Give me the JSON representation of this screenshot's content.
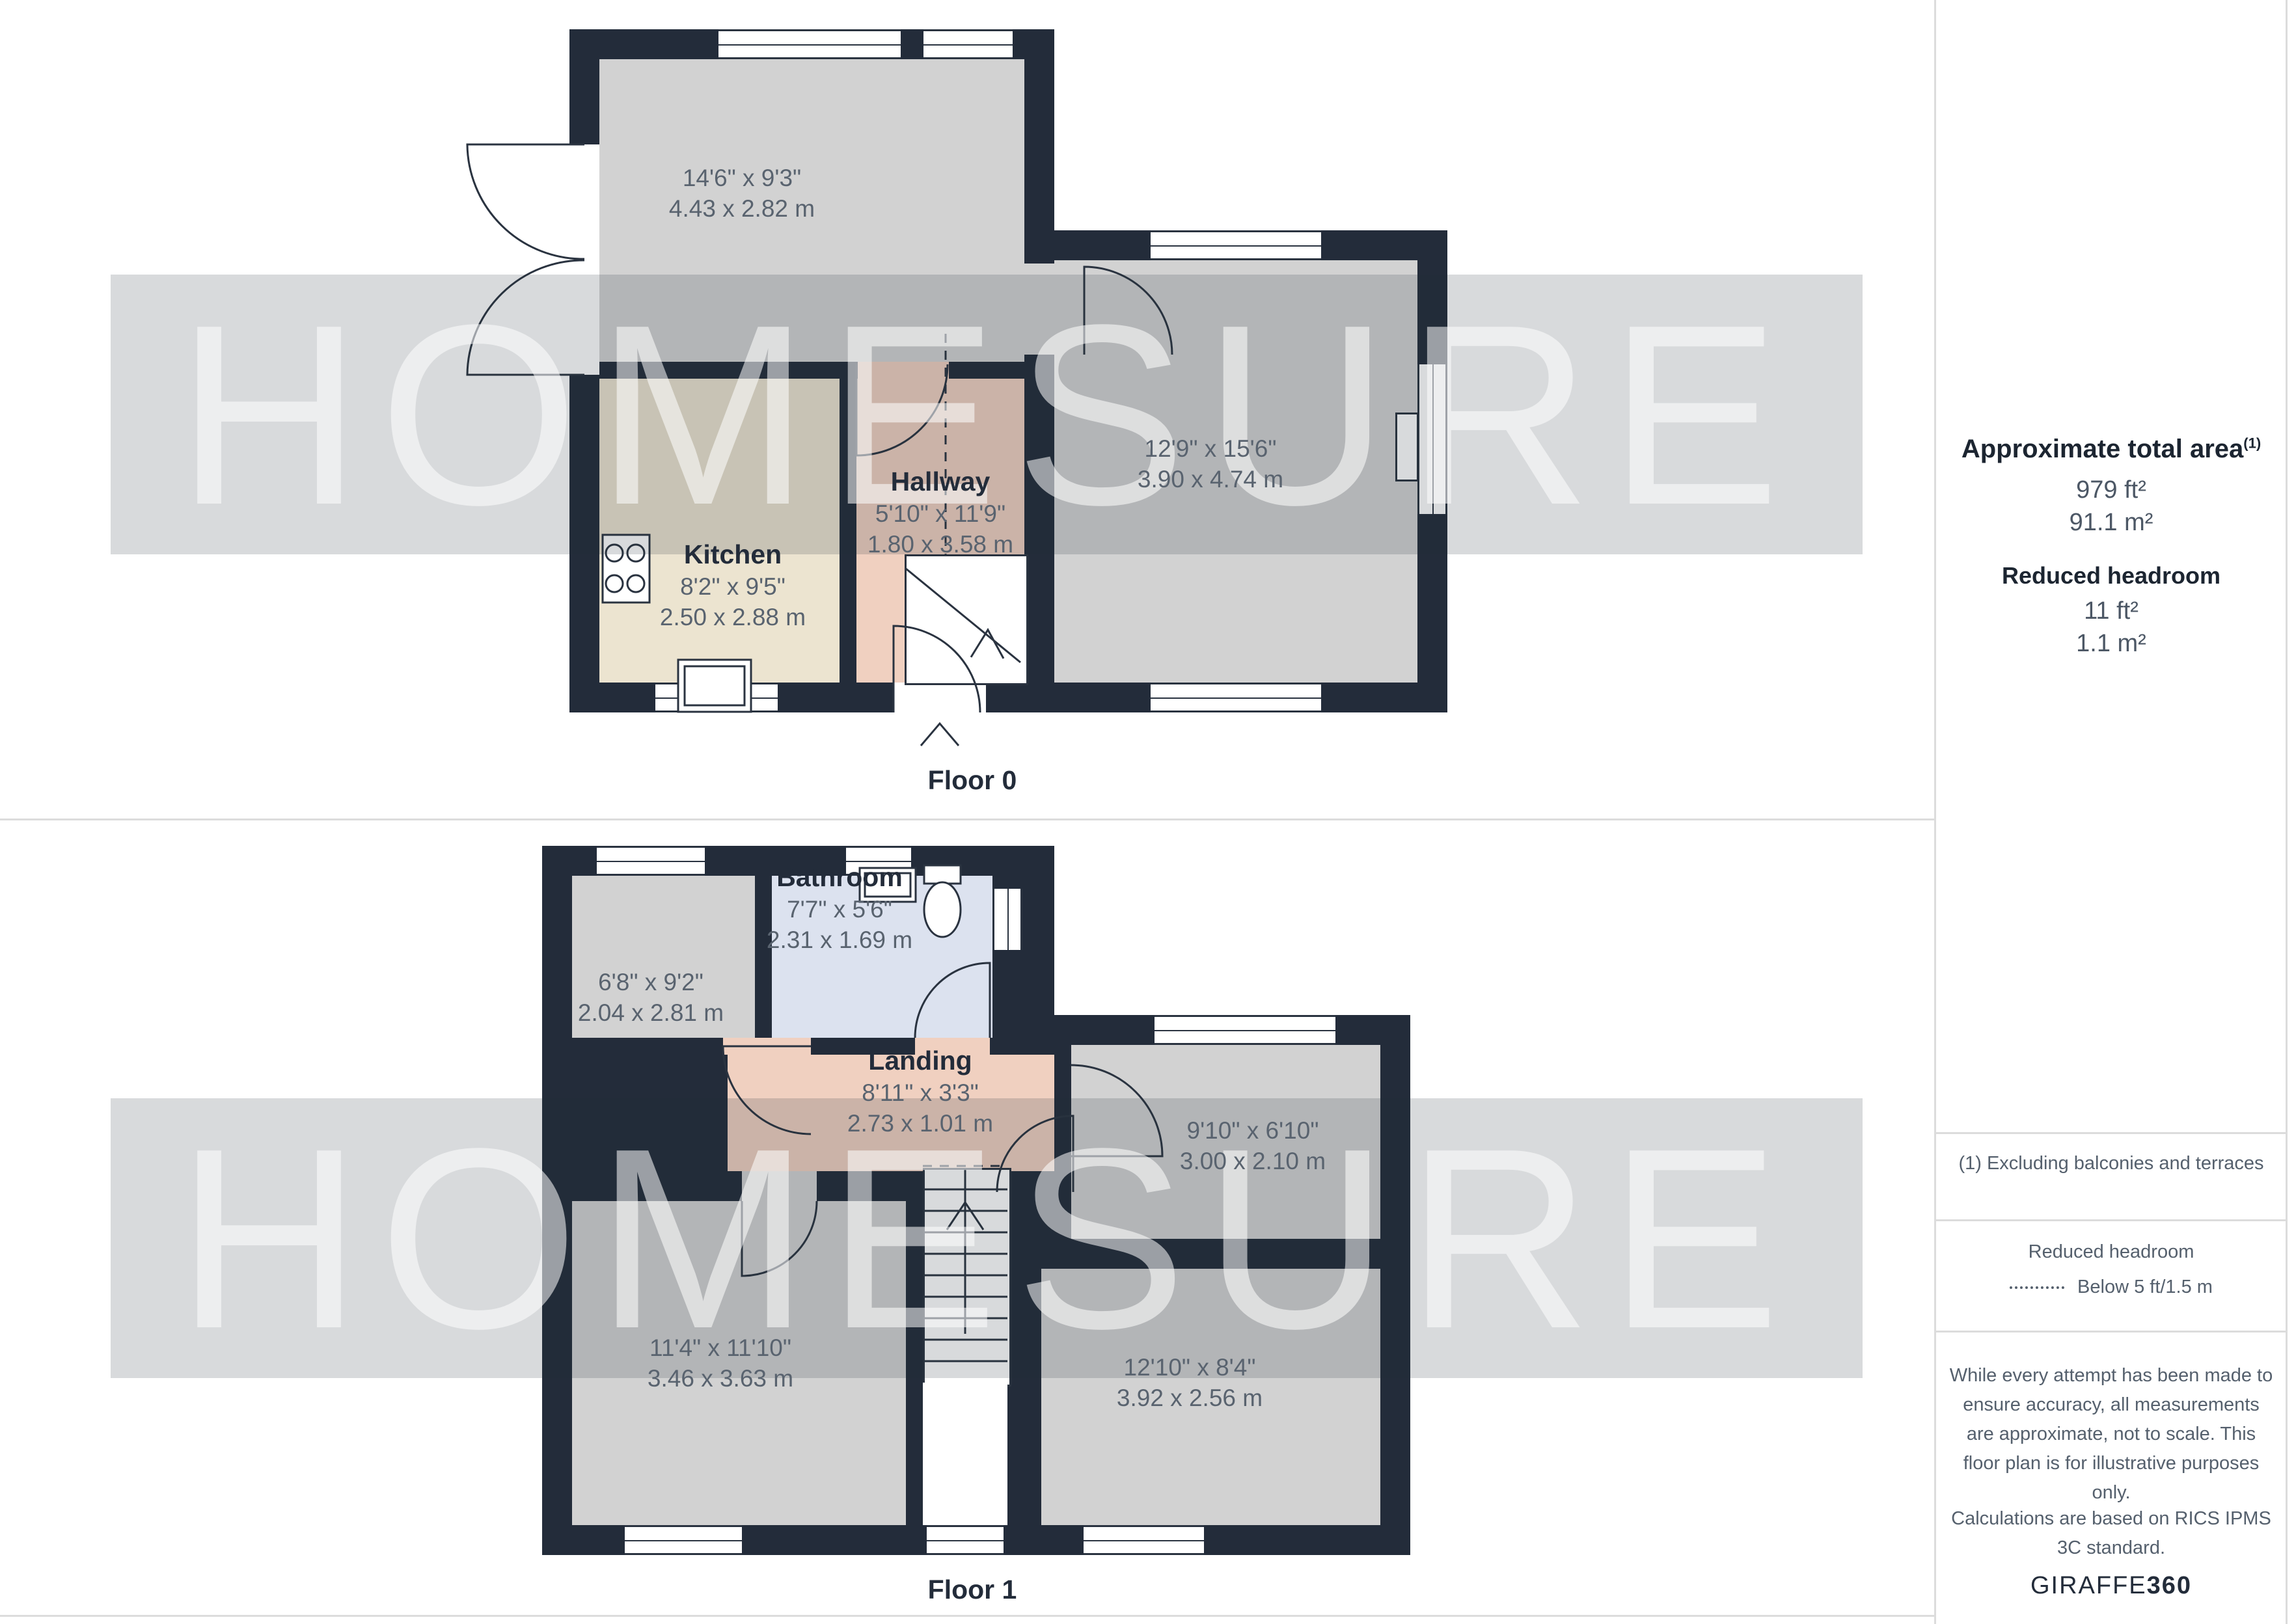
{
  "watermark": {
    "text": "HOMESURE"
  },
  "floors": [
    {
      "caption": "Floor 0",
      "rooms": [
        {
          "name": "",
          "imperial": "14'6\" x 9'3\"",
          "metric": "4.43 x 2.82 m"
        },
        {
          "name": "Kitchen",
          "imperial": "8'2\" x 9'5\"",
          "metric": "2.50 x 2.88 m"
        },
        {
          "name": "Hallway",
          "imperial": "5'10\" x 11'9\"",
          "metric": "1.80 x 3.58 m"
        },
        {
          "name": "",
          "imperial": "12'9\" x 15'6\"",
          "metric": "3.90 x 4.74 m"
        }
      ]
    },
    {
      "caption": "Floor 1",
      "rooms": [
        {
          "name": "",
          "imperial": "6'8\" x 9'2\"",
          "metric": "2.04 x 2.81 m"
        },
        {
          "name": "Bathroom",
          "imperial": "7'7\" x 5'6\"",
          "metric": "2.31 x 1.69 m"
        },
        {
          "name": "Landing",
          "imperial": "8'11\" x 3'3\"",
          "metric": "2.73 x 1.01 m"
        },
        {
          "name": "",
          "imperial": "9'10\" x 6'10\"",
          "metric": "3.00 x 2.10 m"
        },
        {
          "name": "",
          "imperial": "11'4\" x 11'10\"",
          "metric": "3.46 x 3.63 m"
        },
        {
          "name": "",
          "imperial": "12'10\" x 8'4\"",
          "metric": "3.92 x 2.56 m"
        }
      ]
    }
  ],
  "sidebar": {
    "title": "Approximate total area",
    "title_sup": "(1)",
    "total_imperial": "979 ft²",
    "total_metric": "91.1 m²",
    "reduced_title": "Reduced headroom",
    "reduced_imperial": "11 ft²",
    "reduced_metric": "1.1 m²",
    "note": "(1) Excluding balconies and terraces",
    "legend_title": "Reduced headroom",
    "legend_item": "Below 5 ft/1.5 m",
    "disclaimer_1": "While every attempt has been made to ensure accuracy, all measurements are approximate, not to scale. This floor plan is for illustrative purposes only.",
    "disclaimer_2": "Calculations are based on RICS IPMS 3C standard.",
    "brand": "GIRAFFE",
    "brand_suffix": "360"
  },
  "colors": {
    "wall": "#232C3A",
    "room_gray": "#D2D2D2",
    "kitchen_beige": "#ECE4D0",
    "hallway_pink": "#F0D0C0",
    "bathroom_blue": "#DCE2EF",
    "dimension_text": "#59636F",
    "heading_text": "#232C3A"
  }
}
